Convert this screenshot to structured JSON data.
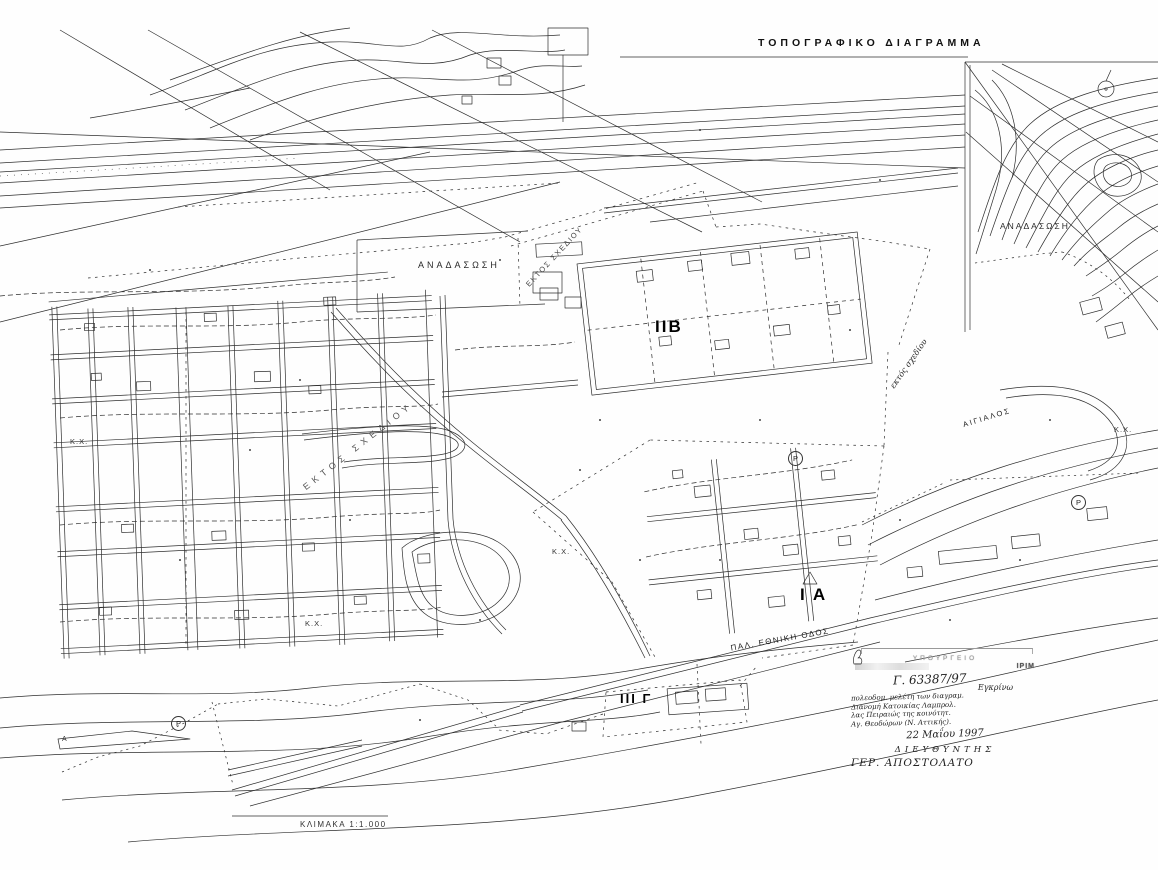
{
  "title": "ΤΟΠΟΓΡΑΦΙΚΟ ΔΙΑΓΡΑΜΜΑ",
  "scale_label": "ΚΛΙΜΑΚΑ  1:1.000",
  "zones": {
    "iib": "ΙΙΒ",
    "ia": "Ι Α",
    "iiig": "ΙΙΙ Γ"
  },
  "area_labels": {
    "anadasosi_central": "ΑΝΑΔΑΣΩΣΗ",
    "anadasosi_right": "ΑΝΑΔΑΣΩΣΗ",
    "ektos_left": "ΕΚΤΟΣ ΣΧΕΔΙΟΥ",
    "ektos_mid": "ΕΚΤΟΣ ΣΧΕΔΙΟΥ",
    "ektos_right": "εκτός σχεδίου",
    "old_national_road": "ΠΑΛ. ΕΘΝΙΚΗ ΟΔΟΣ",
    "aigialos": "ΑΙΓΙΑΛΟΣ",
    "kx_1": "Κ.Χ.",
    "kx_2": "Κ.Χ.",
    "kx_3": "Κ.Χ.",
    "kx_4": "Κ.Χ."
  },
  "markers": {
    "p_road": "P",
    "p_left": "P",
    "p_right": "P",
    "a_left": "A"
  },
  "stamp": {
    "header": "ΥΠΟΥΡΓΕΙΟ",
    "code": "ΙΡΙΜ",
    "ref": "Γ. 63387/97",
    "approve": "Εγκρίνω",
    "note1": "πολεοδομ. μελέτη των διαγραμ.",
    "note2": "Διανομή Κατοικίας Λαμπρολ.",
    "note3": "λας Πειραιώς της κοινότητ.",
    "note4": "Αγ. Θεοδώρων (Ν. Αττικής).",
    "date": "22 Μαΐου 1997",
    "role": "ΔΙΕΥΘΥΝΤΗΣ",
    "signature": "ΓΕΡ. ΑΠΟΣΤΟΛΑΤΟ"
  }
}
